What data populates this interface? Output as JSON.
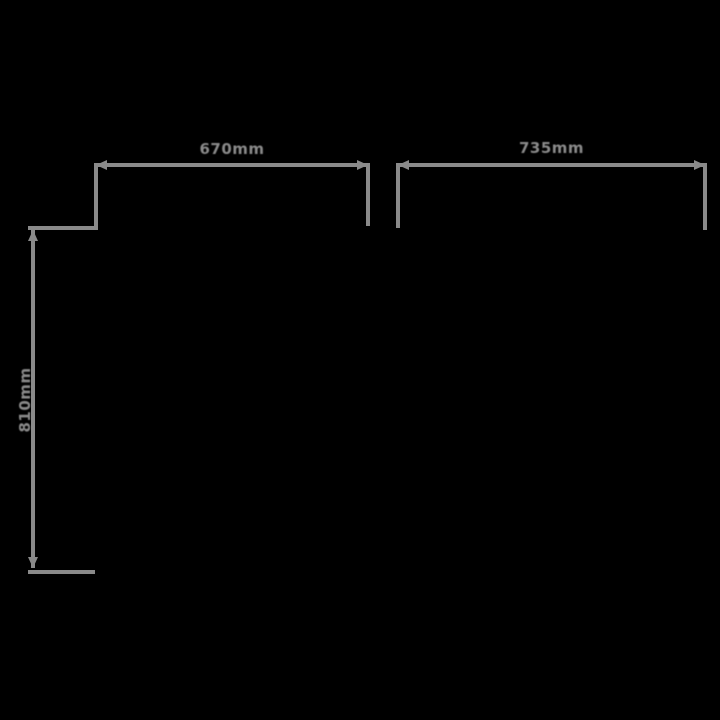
{
  "diagram": {
    "type": "product-dimension-drawing",
    "background_color": "#000000",
    "line_color": "#8a8a8a",
    "unit": "mm",
    "dimensions": [
      {
        "id": "top-left-width",
        "label": "670mm",
        "orientation": "horizontal",
        "position": "top-left"
      },
      {
        "id": "top-right-width",
        "label": "735mm",
        "orientation": "horizontal",
        "position": "top-right"
      },
      {
        "id": "left-height",
        "label": "810mm",
        "orientation": "vertical",
        "position": "left"
      }
    ]
  }
}
